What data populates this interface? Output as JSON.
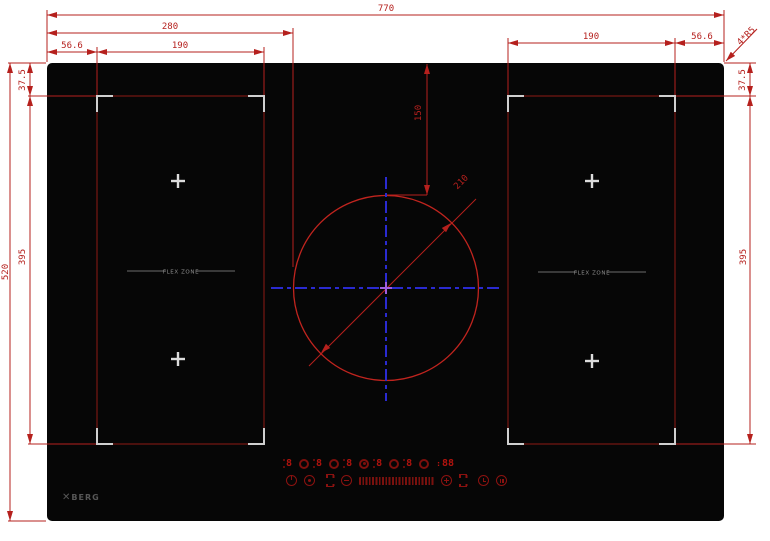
{
  "dims": {
    "total_width": "770",
    "circle_left_offset": "280",
    "left_gap": "56.6",
    "left_zone_width": "190",
    "right_zone_width": "190",
    "right_gap": "56.6",
    "corner_note": "4*R5",
    "total_height": "520",
    "left_top_gap": "37.5",
    "left_zone_height": "395",
    "right_top_gap": "37.5",
    "right_zone_height": "395",
    "circle_top_offset": "150",
    "circle_diameter": "210"
  },
  "zones": {
    "left_label": "FLEX ZONE",
    "right_label": "FLEX ZONE"
  },
  "logo": {
    "mark": "✕",
    "text": "BERG"
  },
  "panel": {
    "burner_displays": [
      "8",
      "8",
      "8",
      "8",
      "8"
    ],
    "timer_colon": ":",
    "timer_display": "88"
  },
  "colors": {
    "dimension_red": "#b5201d",
    "centerline_blue": "#2a2ad0",
    "center_mark_purple": "#9f5fe0",
    "zone_mark_gray": "#cfcfcf",
    "panel_red": "#8b1210",
    "glass_black": "#060606"
  }
}
